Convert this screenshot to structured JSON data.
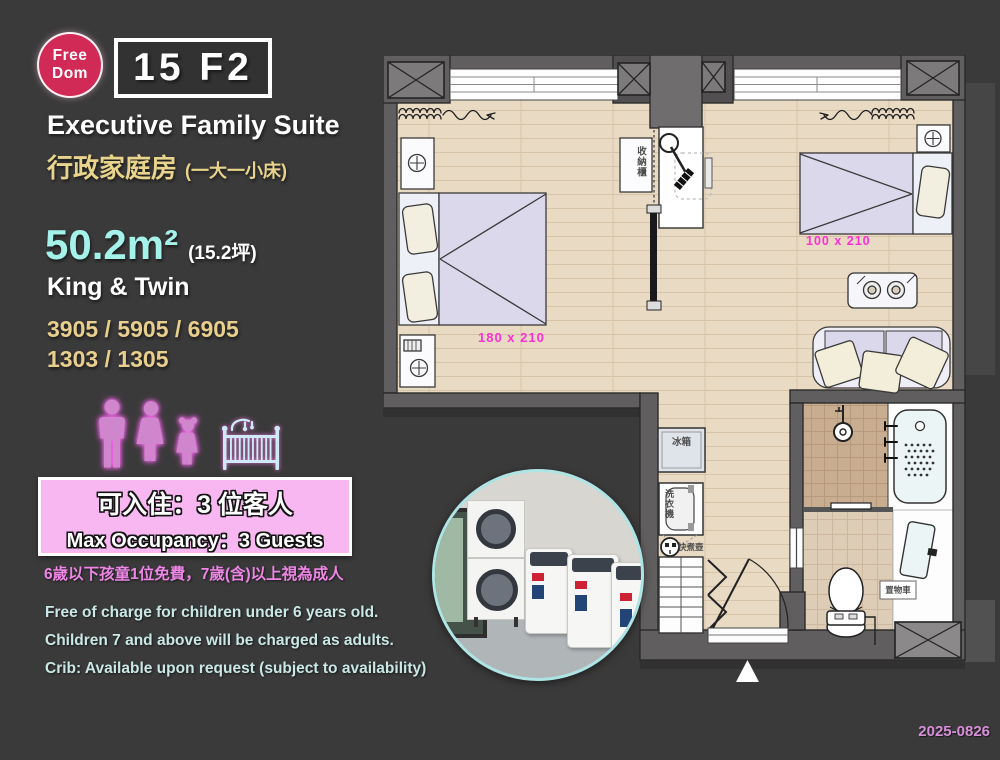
{
  "logo": {
    "top": "Free",
    "bottom": "Dom",
    "color": "#d22a57"
  },
  "header": {
    "room_code": "15 F2",
    "title_en": "Executive Family Suite",
    "title_zh": "行政家庭房",
    "title_zh_note": "(一大一小床)"
  },
  "specs": {
    "area": "50.2m²",
    "area_note": "(15.2坪)",
    "bed_type": "King & Twin",
    "rooms1": "3905 / 5905 / 6905",
    "rooms2": "1303 / 1305"
  },
  "occupancy": {
    "zh": "可入住：3 位客人",
    "en": "Max Occupancy：3 Guests",
    "icons": [
      "man-icon",
      "woman-icon",
      "girl-icon",
      "crib-icon"
    ]
  },
  "policy": {
    "zh": "6歲以下孩童1位免費，7歲(含)以上視為成人",
    "en1": "Free of charge for children under 6 years old.",
    "en2": "Children 7 and above will be charged as adults.",
    "en3": "Crib: Available upon request (subject to availability)"
  },
  "plan": {
    "labels": {
      "storage": "收納櫃",
      "fridge": "冰箱",
      "washer": "洗衣機",
      "kettle": "快煮壺",
      "cart": "置物車"
    },
    "dims": {
      "king": "180 x 210",
      "twin": "100 x 210"
    },
    "colors": {
      "dim_label": "#ff2ed2",
      "wall": "#605e5f",
      "floor": "#e9dac4"
    }
  },
  "footer": {
    "date": "2025-0826"
  },
  "colors": {
    "background": "#3b3a3b",
    "accent_cyan": "#a5f2ea",
    "accent_gold": "#e8cf8e",
    "box_pink": "#f8b7f1",
    "policy_pink": "#ee86e6",
    "policy_cyan": "#c9e8e5",
    "date_pink": "#d78fd7"
  }
}
